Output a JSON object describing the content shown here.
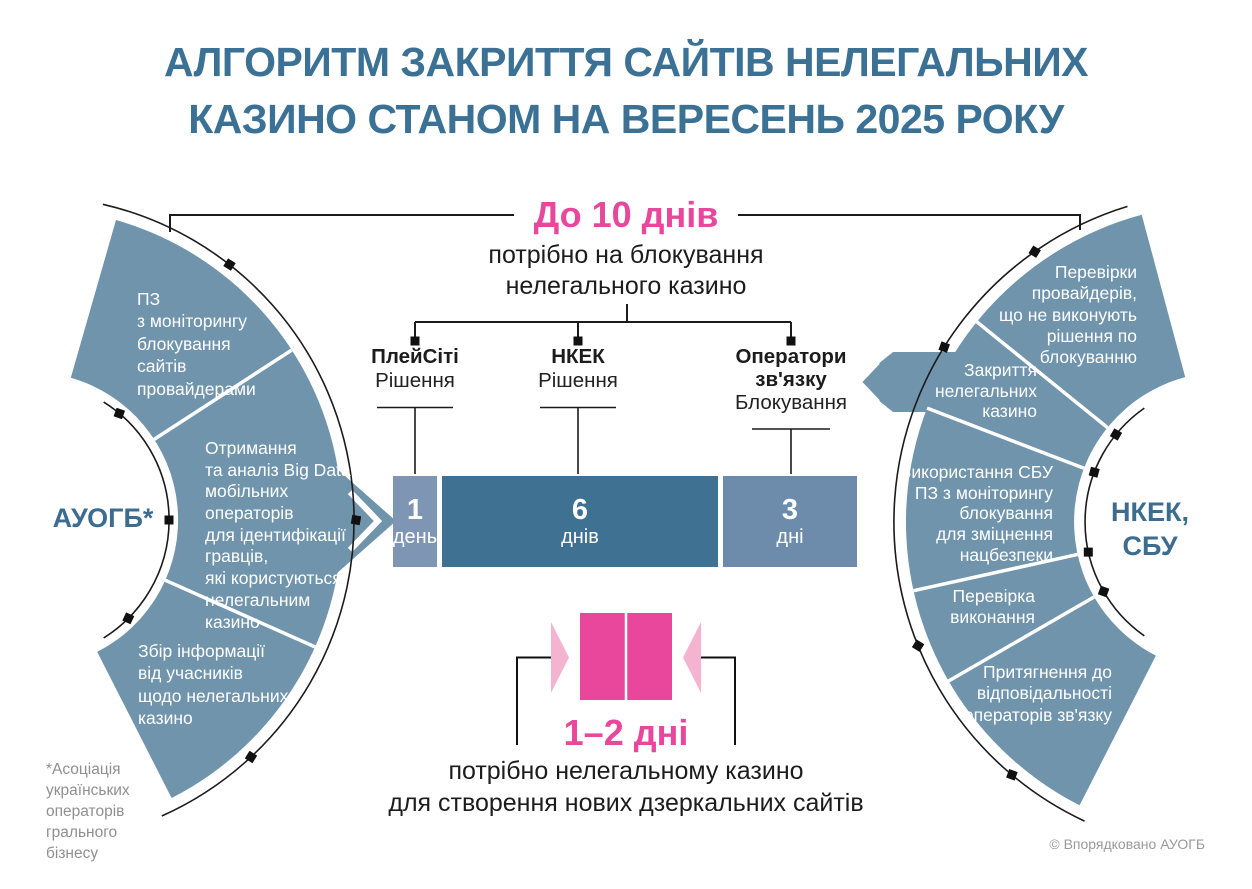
{
  "title": {
    "text": "АЛГОРИТМ ЗАКРИТТЯ САЙТІВ НЕЛЕГАЛЬНИХ\nКАЗИНО СТАНОМ НА ВЕРЕСЕНЬ 2025 РОКУ"
  },
  "top_bracket": {
    "duration": "До 10 днів",
    "subtitle": "потрібно на блокування\nнелегального казино"
  },
  "columns": [
    {
      "name": "ПлейСіті",
      "action": "Рішення"
    },
    {
      "name": "НКЕК",
      "action": "Рішення"
    },
    {
      "name": "Оператори\nзв'язку",
      "action": "Блокування"
    }
  ],
  "timeline_bar": {
    "segments": [
      {
        "value": "1",
        "unit": "день"
      },
      {
        "value": "6",
        "unit": "днів"
      },
      {
        "value": "3",
        "unit": "дні"
      }
    ]
  },
  "left_fan": {
    "label": "АУОГБ*",
    "segments": [
      "ПЗ\nз моніторингу\nблокування\nсайтів\nпровайдерами",
      "Отримання\nта аналіз Big Data\nмобільних\nоператорів\nдля ідентифікації\nгравців,\nякі користуються\nнелегальним\nказино",
      "Збір інформації\nвід учасників\nщодо нелегальних\nказино"
    ]
  },
  "right_fan": {
    "label": "НКЕК,\nСБУ",
    "segments": [
      "Перевірки\nпровайдерів,\nщо не виконують\nрішення по\nблокуванню",
      "Закриття\nнелегальних\nказино",
      "Використання СБУ\nПЗ з моніторингу\nблокування\nдля зміцнення\nнацбезпеки",
      "Перевірка\nвиконання",
      "Притягнення до\nвідповідальності\nоператорів зв'язку"
    ]
  },
  "mirror_note": {
    "duration": "1–2 дні",
    "subtitle": "потрібно нелегальному казино\nдля створення нових дзеркальних сайтів"
  },
  "footnote": "*Асоціація\nукраїнських\nоператорів\nгрального\nбізнесу",
  "copyright": "© Впорядковано АУОГБ",
  "colors": {
    "accent_blue": "#3B7195",
    "fan_blue": "#6F94AC",
    "bar_dark": "#3E7192",
    "bar_medium": "#6D8CAB",
    "bar_light": "#7E96B4",
    "pink": "#E8479B",
    "pink_light": "#F5B3D2",
    "line_black": "#1B1B1B"
  }
}
